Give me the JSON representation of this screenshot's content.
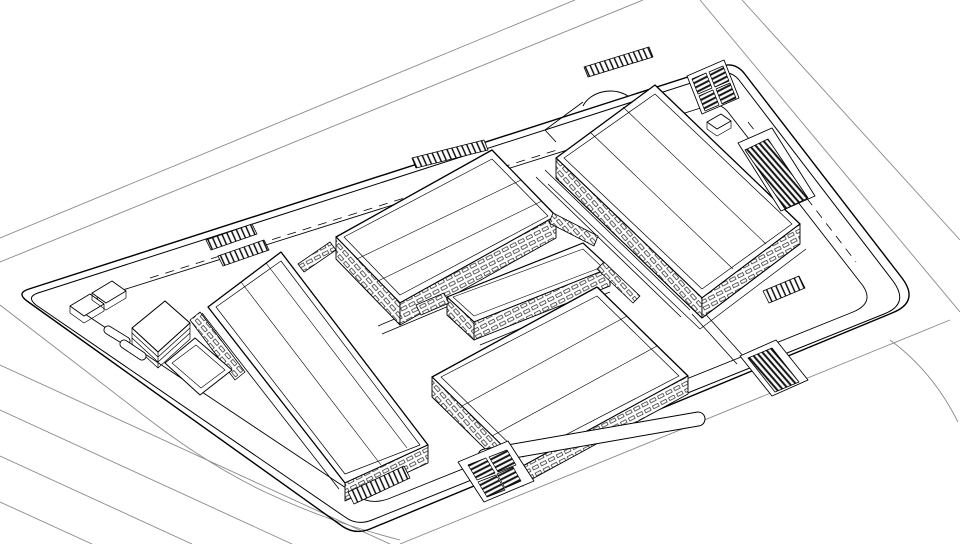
{
  "meta": {
    "canvas": {
      "width": 960,
      "height": 544
    },
    "colors": {
      "background": "#ffffff",
      "line": "#000000",
      "faint_road": "#8a8a8a",
      "hatch": "#111111"
    },
    "scene": "axonometric-site-plan-line-drawing"
  },
  "drawing": {
    "patterns": [
      {
        "id": "winU",
        "type": "windows",
        "tile": [
          9,
          6.5
        ],
        "rotate": -27,
        "bg": "#ffffff",
        "fg": "#000000"
      },
      {
        "id": "winV",
        "type": "windows",
        "tile": [
          9,
          6.5
        ],
        "rotate": 49,
        "bg": "#ffffff",
        "fg": "#000000"
      },
      {
        "id": "ladderU",
        "type": "stripes",
        "tile": [
          5,
          9
        ],
        "rotate": -24,
        "bg": "#ffffff",
        "fg": "#000000",
        "lineWidth": 1.4
      },
      {
        "id": "stripesA",
        "type": "stripes",
        "tile": [
          4.5,
          4.5
        ],
        "rotate": 63,
        "bg": "#ffffff",
        "fg": "#111111",
        "lineWidth": 2
      },
      {
        "id": "stripesB",
        "type": "stripes",
        "tile": [
          4.5,
          4.5
        ],
        "rotate": -41,
        "bg": "#ffffff",
        "fg": "#111111",
        "lineWidth": 2
      }
    ],
    "paths": [
      {
        "name": "road-top-lane-1",
        "d": "M 0,238 L 575,0",
        "stroke": "#8a8a8a",
        "w": 0.9
      },
      {
        "name": "road-top-lane-2",
        "d": "M 0,262 L 643,0",
        "stroke": "#8a8a8a",
        "w": 0.9
      },
      {
        "name": "road-left-outer",
        "d": "M 0,305 L 130,405 C 175,440 215,468 265,492 C 310,513 350,527 400,540",
        "stroke": "#8a8a8a",
        "w": 0.9
      },
      {
        "name": "road-bottom-lane-1",
        "d": "M 0,365 L 390,544",
        "stroke": "#8a8a8a",
        "w": 0.9
      },
      {
        "name": "road-bottom-lane-2",
        "d": "M 0,410 L 292,544",
        "stroke": "#8a8a8a",
        "w": 0.9
      },
      {
        "name": "road-bottom-lane-3",
        "d": "M 0,456 L 192,544",
        "stroke": "#8a8a8a",
        "w": 0.9
      },
      {
        "name": "road-bottom-lane-4",
        "d": "M 0,502 L 92,544",
        "stroke": "#8a8a8a",
        "w": 0.9
      },
      {
        "name": "road-right-lane-1",
        "d": "M 700,0 L 960,312",
        "stroke": "#8a8a8a",
        "w": 0.9
      },
      {
        "name": "road-right-lane-2",
        "d": "M 742,0 L 960,240",
        "stroke": "#8a8a8a",
        "w": 0.9
      },
      {
        "name": "road-right-curve",
        "d": "M 890,340 C 920,362 942,390 958,422",
        "stroke": "#8a8a8a",
        "w": 0.9
      },
      {
        "name": "road-bottom-outer",
        "d": "M 400,544 L 950,320",
        "stroke": "#8a8a8a",
        "w": 0.9
      },
      {
        "name": "site-boundary-outer",
        "d": "M 29,289 L 722,66 Q 735,62 744,73 L 902,278 Q 920,302 892,313 L 370,529 Q 355,535 342,526 L 27,301 Q 16,293 29,289 Z",
        "stroke": "#000000",
        "w": 1.4
      },
      {
        "name": "site-boundary-inner",
        "d": "M 38,293 L 719,74 Q 731,70 739,80 L 893,281 Q 910,304 884,314 L 372,520 Q 357,526 345,517 L 36,305 Q 26,297 38,293 Z",
        "stroke": "#000000",
        "w": 1.0
      },
      {
        "name": "sidewalk-ring",
        "d": "M 88,301 L 707,106 Q 720,102 728,112 L 860,282 Q 877,302 853,312 L 388,499 Q 370,505 358,496 L 85,314 Q 75,306 88,301 Z",
        "stroke": "#000000",
        "w": 0.9
      },
      {
        "name": "sidewalk-dashes-top",
        "d": "M 150,278 L 560,149",
        "stroke": "#000000",
        "w": 0.8,
        "dash": "9 7"
      },
      {
        "name": "sidewalk-dashes-right",
        "d": "M 748,122 L 856,262",
        "stroke": "#000000",
        "w": 0.8,
        "dash": "9 7"
      },
      {
        "name": "street-b1-west-1",
        "d": "M 545,170 L 690,310",
        "stroke": "#000000",
        "w": 0.8
      },
      {
        "name": "street-b1-west-2",
        "d": "M 536,177 L 681,317",
        "stroke": "#000000",
        "w": 0.8
      },
      {
        "name": "street-b3-b4-1",
        "d": "M 480,345 L 610,292",
        "stroke": "#000000",
        "w": 0.8
      },
      {
        "name": "street-b3-b4-2",
        "d": "M 474,355 L 604,302",
        "stroke": "#000000",
        "w": 0.8
      },
      {
        "name": "street-b5-b3-1",
        "d": "M 378,326 L 452,295",
        "stroke": "#000000",
        "w": 0.8
      },
      {
        "name": "street-b5-b3-2",
        "d": "M 382,334 L 456,303",
        "stroke": "#000000",
        "w": 0.8
      },
      {
        "name": "street-b4-b1-1",
        "d": "M 700,308 L 745,358",
        "stroke": "#000000",
        "w": 0.8
      },
      {
        "name": "street-b4-b1-2",
        "d": "M 692,314 L 737,364",
        "stroke": "#000000",
        "w": 0.8
      },
      {
        "name": "building-5-walk-edge",
        "d": "M 202,313 L 339,489",
        "stroke": "#000000",
        "w": 0.8
      },
      {
        "name": "building-5-roof",
        "d": "M 281,252 L 428,445 L 345,483 L 208,307 Z",
        "stroke": "#000000",
        "w": 1.3,
        "fill": "#ffffff"
      },
      {
        "name": "building-5-roof-inset",
        "d": "M 281,261 L 420,445 L 345,474 L 216,307 Z",
        "stroke": "#000000",
        "w": 0.7
      },
      {
        "name": "building-5-ridge-1",
        "d": "M 241,282 L 381,465",
        "stroke": "#000000",
        "w": 0.6
      },
      {
        "name": "building-5-ridge-2",
        "d": "M 266,263 L 407,448",
        "stroke": "#000000",
        "w": 0.6
      },
      {
        "name": "building-5-window-band-se",
        "d": "M 345,483 L 428,445 L 428,463 L 345,501 Z",
        "stroke": "#000000",
        "w": 0.9,
        "fill": "pattern:winU"
      },
      {
        "name": "building-5-west-wing-band",
        "d": "M 200,312 L 245,372 L 235,380 L 190,320 Z",
        "stroke": "#000000",
        "w": 0.8,
        "fill": "pattern:winV"
      },
      {
        "name": "building-5-stair-apron",
        "d": "M 348,492 L 404,466 L 410,478 L 354,504 Z",
        "stroke": "#000000",
        "w": 0.8,
        "fill": "pattern:ladderU"
      },
      {
        "name": "building-6-roof",
        "d": "M 165,301 L 190,323 L 158,352 L 132,328 Z",
        "stroke": "#000000",
        "w": 1.1,
        "fill": "#ffffff"
      },
      {
        "name": "building-6-floor-lines",
        "d": "M 132,328 L 132,344 L 158,368 L 190,339 L 190,323 M 158,352 L 158,368 M 132,333 L 158,357 L 190,328 M 132,338 L 158,362 L 190,333",
        "stroke": "#000000",
        "w": 0.7
      },
      {
        "name": "ramp-canopy-roof",
        "d": "M 195,338 L 232,370 L 200,395 L 165,363 Z",
        "stroke": "#000000",
        "w": 1.0,
        "fill": "#ffffff"
      },
      {
        "name": "ramp-canopy-inset",
        "d": "M 196,345 L 225,370 L 201,388 L 172,363 Z",
        "stroke": "#000000",
        "w": 0.6
      },
      {
        "name": "shed-1-roof",
        "d": "M 70,306 L 90,294 L 104,304 L 84,316 Z",
        "stroke": "#000000",
        "w": 0.9,
        "fill": "#ffffff"
      },
      {
        "name": "shed-1-base",
        "d": "M 70,306 L 70,313 L 84,323 L 104,311 L 104,304",
        "stroke": "#000000",
        "w": 0.7
      },
      {
        "name": "shed-2-roof",
        "d": "M 92,293 L 112,281 L 126,291 L 106,303 Z",
        "stroke": "#000000",
        "w": 0.9,
        "fill": "#ffffff"
      },
      {
        "name": "shed-2-base",
        "d": "M 92,293 L 92,300 L 106,310 L 126,298 L 126,291",
        "stroke": "#000000",
        "w": 0.7
      },
      {
        "name": "ground-island-1-outline",
        "d": "M 108,330 L 126,341",
        "stroke": "#000000",
        "w": 9,
        "cap": "round"
      },
      {
        "name": "ground-island-1-fill",
        "d": "M 108,330 L 126,341",
        "stroke": "#ffffff",
        "w": 7.2,
        "cap": "round"
      },
      {
        "name": "ground-island-2-outline",
        "d": "M 124,344 L 142,356",
        "stroke": "#000000",
        "w": 9,
        "cap": "round"
      },
      {
        "name": "ground-island-2-fill",
        "d": "M 124,344 L 142,356",
        "stroke": "#ffffff",
        "w": 7.2,
        "cap": "round"
      },
      {
        "name": "crosswalk-strip-1",
        "d": "M 206,240 L 252,224 L 257,234 L 211,250 Z",
        "stroke": "#000000",
        "w": 0.8,
        "fill": "pattern:ladderU"
      },
      {
        "name": "crosswalk-strip-2",
        "d": "M 218,256 L 264,240 L 269,250 L 223,266 Z",
        "stroke": "#000000",
        "w": 0.8,
        "fill": "pattern:ladderU"
      },
      {
        "name": "crosswalk-strip-top",
        "d": "M 412,158 L 484,140 L 488,150 L 416,168 Z",
        "stroke": "#000000",
        "w": 0.8,
        "fill": "pattern:ladderU"
      },
      {
        "name": "building-2-roof",
        "d": "M 492,150 L 556,216 L 400,303 L 336,237 Z",
        "stroke": "#000000",
        "w": 1.3,
        "fill": "#ffffff"
      },
      {
        "name": "building-2-roof-inset",
        "d": "M 492,159 L 548,216 L 400,295 L 344,237 Z",
        "stroke": "#000000",
        "w": 0.7
      },
      {
        "name": "building-2-ridge-1",
        "d": "M 357,259 L 521,180",
        "stroke": "#000000",
        "w": 0.6
      },
      {
        "name": "building-2-ridge-2",
        "d": "M 378,281 L 542,201",
        "stroke": "#000000",
        "w": 0.6
      },
      {
        "name": "building-2-window-band-sw",
        "d": "M 336,237 L 400,303 L 400,325 L 336,259 Z",
        "stroke": "#000000",
        "w": 0.9,
        "fill": "pattern:winV"
      },
      {
        "name": "building-2-window-band-se",
        "d": "M 400,303 L 556,216 L 556,238 L 400,325 Z",
        "stroke": "#000000",
        "w": 0.9,
        "fill": "pattern:winU"
      },
      {
        "name": "bridge-b2-b5",
        "d": "M 298,264 L 330,242 L 336,250 L 304,272 Z",
        "stroke": "#000000",
        "w": 0.8,
        "fill": "pattern:winU"
      },
      {
        "name": "bridge-b2-b1",
        "d": "M 553,213 L 598,236 L 594,246 L 549,223 Z",
        "stroke": "#000000",
        "w": 0.8,
        "fill": "pattern:winV"
      },
      {
        "name": "building-3-roof",
        "d": "M 583,243 L 610,268 L 474,322 L 447,297 Z",
        "stroke": "#000000",
        "w": 1.2,
        "fill": "#ffffff"
      },
      {
        "name": "building-3-roof-inset",
        "d": "M 583,249 L 602,267 L 474,316 L 453,297 Z",
        "stroke": "#000000",
        "w": 0.6
      },
      {
        "name": "building-3-window-band-se",
        "d": "M 474,322 L 610,268 L 610,286 L 474,340 Z",
        "stroke": "#000000",
        "w": 0.9,
        "fill": "pattern:winU"
      },
      {
        "name": "building-3-window-band-sw",
        "d": "M 447,297 L 474,322 L 474,340 L 447,315 Z",
        "stroke": "#000000",
        "w": 0.9,
        "fill": "pattern:winV"
      },
      {
        "name": "bridge-b3-b5",
        "d": "M 416,305 L 444,293 L 449,303 L 421,315 Z",
        "stroke": "#000000",
        "w": 0.8,
        "fill": "pattern:winU"
      },
      {
        "name": "bridge-b3-b4",
        "d": "M 604,262 L 640,296 L 633,303 L 597,269 Z",
        "stroke": "#000000",
        "w": 0.8,
        "fill": "pattern:winV"
      },
      {
        "name": "building-4-roof",
        "d": "M 597,287 L 688,376 L 523,466 L 432,377 Z",
        "stroke": "#000000",
        "w": 1.3,
        "fill": "#ffffff"
      },
      {
        "name": "building-4-roof-inset",
        "d": "M 597,296 L 679,376 L 523,457 L 441,377 Z",
        "stroke": "#000000",
        "w": 0.7
      },
      {
        "name": "building-4-ridge-1",
        "d": "M 462,406 L 627,316",
        "stroke": "#000000",
        "w": 0.6
      },
      {
        "name": "building-4-ridge-2",
        "d": "M 492,436 L 657,346",
        "stroke": "#000000",
        "w": 0.6
      },
      {
        "name": "building-4-window-band-sw",
        "d": "M 432,377 L 523,466 L 523,486 L 432,397 Z",
        "stroke": "#000000",
        "w": 0.9,
        "fill": "pattern:winV"
      },
      {
        "name": "building-4-window-band-se",
        "d": "M 523,466 L 688,376 L 688,394 L 523,484 Z",
        "stroke": "#000000",
        "w": 0.9,
        "fill": "pattern:winU"
      },
      {
        "name": "walkway-pill-outline",
        "d": "M 485,456 L 698,419",
        "stroke": "#000000",
        "w": 15,
        "cap": "round"
      },
      {
        "name": "walkway-pill-fill",
        "d": "M 485,456 L 698,419",
        "stroke": "#ffffff",
        "w": 13,
        "cap": "round"
      },
      {
        "name": "building-1-roof",
        "d": "M 655,85 L 800,224 L 702,298 L 556,158 Z",
        "stroke": "#000000",
        "w": 1.3,
        "fill": "#ffffff"
      },
      {
        "name": "building-1-roof-inset",
        "d": "M 655,94 L 792,224 L 702,289 L 564,158 Z",
        "stroke": "#000000",
        "w": 0.7
      },
      {
        "name": "building-1-ridge-1",
        "d": "M 590,132 L 733,269",
        "stroke": "#000000",
        "w": 0.6
      },
      {
        "name": "building-1-ridge-2",
        "d": "M 623,107 L 766,244",
        "stroke": "#000000",
        "w": 0.6
      },
      {
        "name": "building-1-window-band-sw",
        "d": "M 556,158 L 702,298 L 702,318 L 556,178 Z",
        "stroke": "#000000",
        "w": 0.9,
        "fill": "pattern:winV"
      },
      {
        "name": "building-1-window-band-se",
        "d": "M 702,298 L 800,224 L 800,244 L 702,318 Z",
        "stroke": "#000000",
        "w": 0.9,
        "fill": "pattern:winU"
      },
      {
        "name": "building-1-base-line-1",
        "d": "M 556,178 L 702,318 L 800,244",
        "stroke": "#000000",
        "w": 1.0
      },
      {
        "name": "building-1-base-line-2",
        "d": "M 548,184 L 700,329 L 806,249",
        "stroke": "#000000",
        "w": 0.7
      },
      {
        "name": "building-1-parapet-step",
        "d": "M 545,130 L 583,102 M 545,130 L 556,142",
        "stroke": "#000000",
        "w": 0.9
      },
      {
        "name": "building-1-entrance-arc",
        "d": "M 583,106 C 590,92 612,86 628,96",
        "stroke": "#000000",
        "w": 1.0
      },
      {
        "name": "building-1-top-ladder-strip",
        "d": "M 584,67 L 649,47 L 653,57 L 588,77 Z",
        "stroke": "#000000",
        "w": 0.8,
        "fill": "pattern:ladderU"
      },
      {
        "name": "solar-array-frame-topright",
        "d": "M 687,76 L 724,60 L 739,98 L 702,114 Z",
        "stroke": "#000000",
        "w": 0.9,
        "fill": "#ffffff"
      },
      {
        "name": "solar-panel-tr-1",
        "d": "M 692,79 L 706,73 L 712,88 L 698,94 Z",
        "stroke": "#000000",
        "w": 0.7,
        "fill": "pattern:stripesA"
      },
      {
        "name": "solar-panel-tr-2",
        "d": "M 709,72 L 723,66 L 729,81 L 715,87 Z",
        "stroke": "#000000",
        "w": 0.7,
        "fill": "pattern:stripesA"
      },
      {
        "name": "solar-panel-tr-3",
        "d": "M 699,96 L 713,90 L 719,105 L 705,111 Z",
        "stroke": "#000000",
        "w": 0.7,
        "fill": "pattern:stripesA"
      },
      {
        "name": "solar-panel-tr-4",
        "d": "M 716,89 L 730,83 L 736,98 L 722,104 Z",
        "stroke": "#000000",
        "w": 0.7,
        "fill": "pattern:stripesA"
      },
      {
        "name": "rooftop-cube-top",
        "d": "M 707,122 L 721,114 L 731,121 L 717,129 Z",
        "stroke": "#000000",
        "w": 0.9,
        "fill": "#ffffff"
      },
      {
        "name": "rooftop-cube-side",
        "d": "M 707,122 L 707,129 L 717,136 L 731,128 L 731,121",
        "stroke": "#000000",
        "w": 0.7
      },
      {
        "name": "louver-frame",
        "d": "M 738,143 L 772,128 L 815,196 L 781,211 Z",
        "stroke": "#000000",
        "w": 0.9,
        "fill": "#ffffff"
      },
      {
        "name": "louver-stripes",
        "d": "M 745,150 L 768,139 L 808,198 L 785,209 Z",
        "stroke": "#000000",
        "w": 0.8,
        "fill": "pattern:stripesB"
      },
      {
        "name": "building-1-stair-apron",
        "d": "M 763,291 L 799,276 L 805,288 L 769,303 Z",
        "stroke": "#000000",
        "w": 0.8,
        "fill": "pattern:ladderU"
      },
      {
        "name": "ramp-frame-bottomright",
        "d": "M 740,356 L 776,340 L 808,380 L 772,396 Z",
        "stroke": "#000000",
        "w": 0.9,
        "fill": "#ffffff"
      },
      {
        "name": "ramp-stripes-bottomright",
        "d": "M 748,358 L 772,348 L 799,382 L 775,392 Z",
        "stroke": "#000000",
        "w": 0.8,
        "fill": "pattern:stripesB"
      },
      {
        "name": "solar-array-frame-bottom",
        "d": "M 458,462 L 508,441 L 534,481 L 484,502 Z",
        "stroke": "#000000",
        "w": 0.9,
        "fill": "#ffffff"
      },
      {
        "name": "solar-panel-bc-1",
        "d": "M 468,465 L 486,458 L 495,473 L 477,480 Z",
        "stroke": "#000000",
        "w": 0.7,
        "fill": "pattern:stripesA"
      },
      {
        "name": "solar-panel-bc-2",
        "d": "M 489,457 L 507,450 L 516,465 L 498,472 Z",
        "stroke": "#000000",
        "w": 0.7,
        "fill": "pattern:stripesA"
      },
      {
        "name": "solar-panel-bc-3",
        "d": "M 478,482 L 496,475 L 505,490 L 487,497 Z",
        "stroke": "#000000",
        "w": 0.7,
        "fill": "pattern:stripesA"
      },
      {
        "name": "solar-panel-bc-4",
        "d": "M 497,474 L 513,467 L 521,481 L 505,488 Z",
        "stroke": "#000000",
        "w": 0.7,
        "fill": "pattern:stripesA"
      }
    ]
  }
}
